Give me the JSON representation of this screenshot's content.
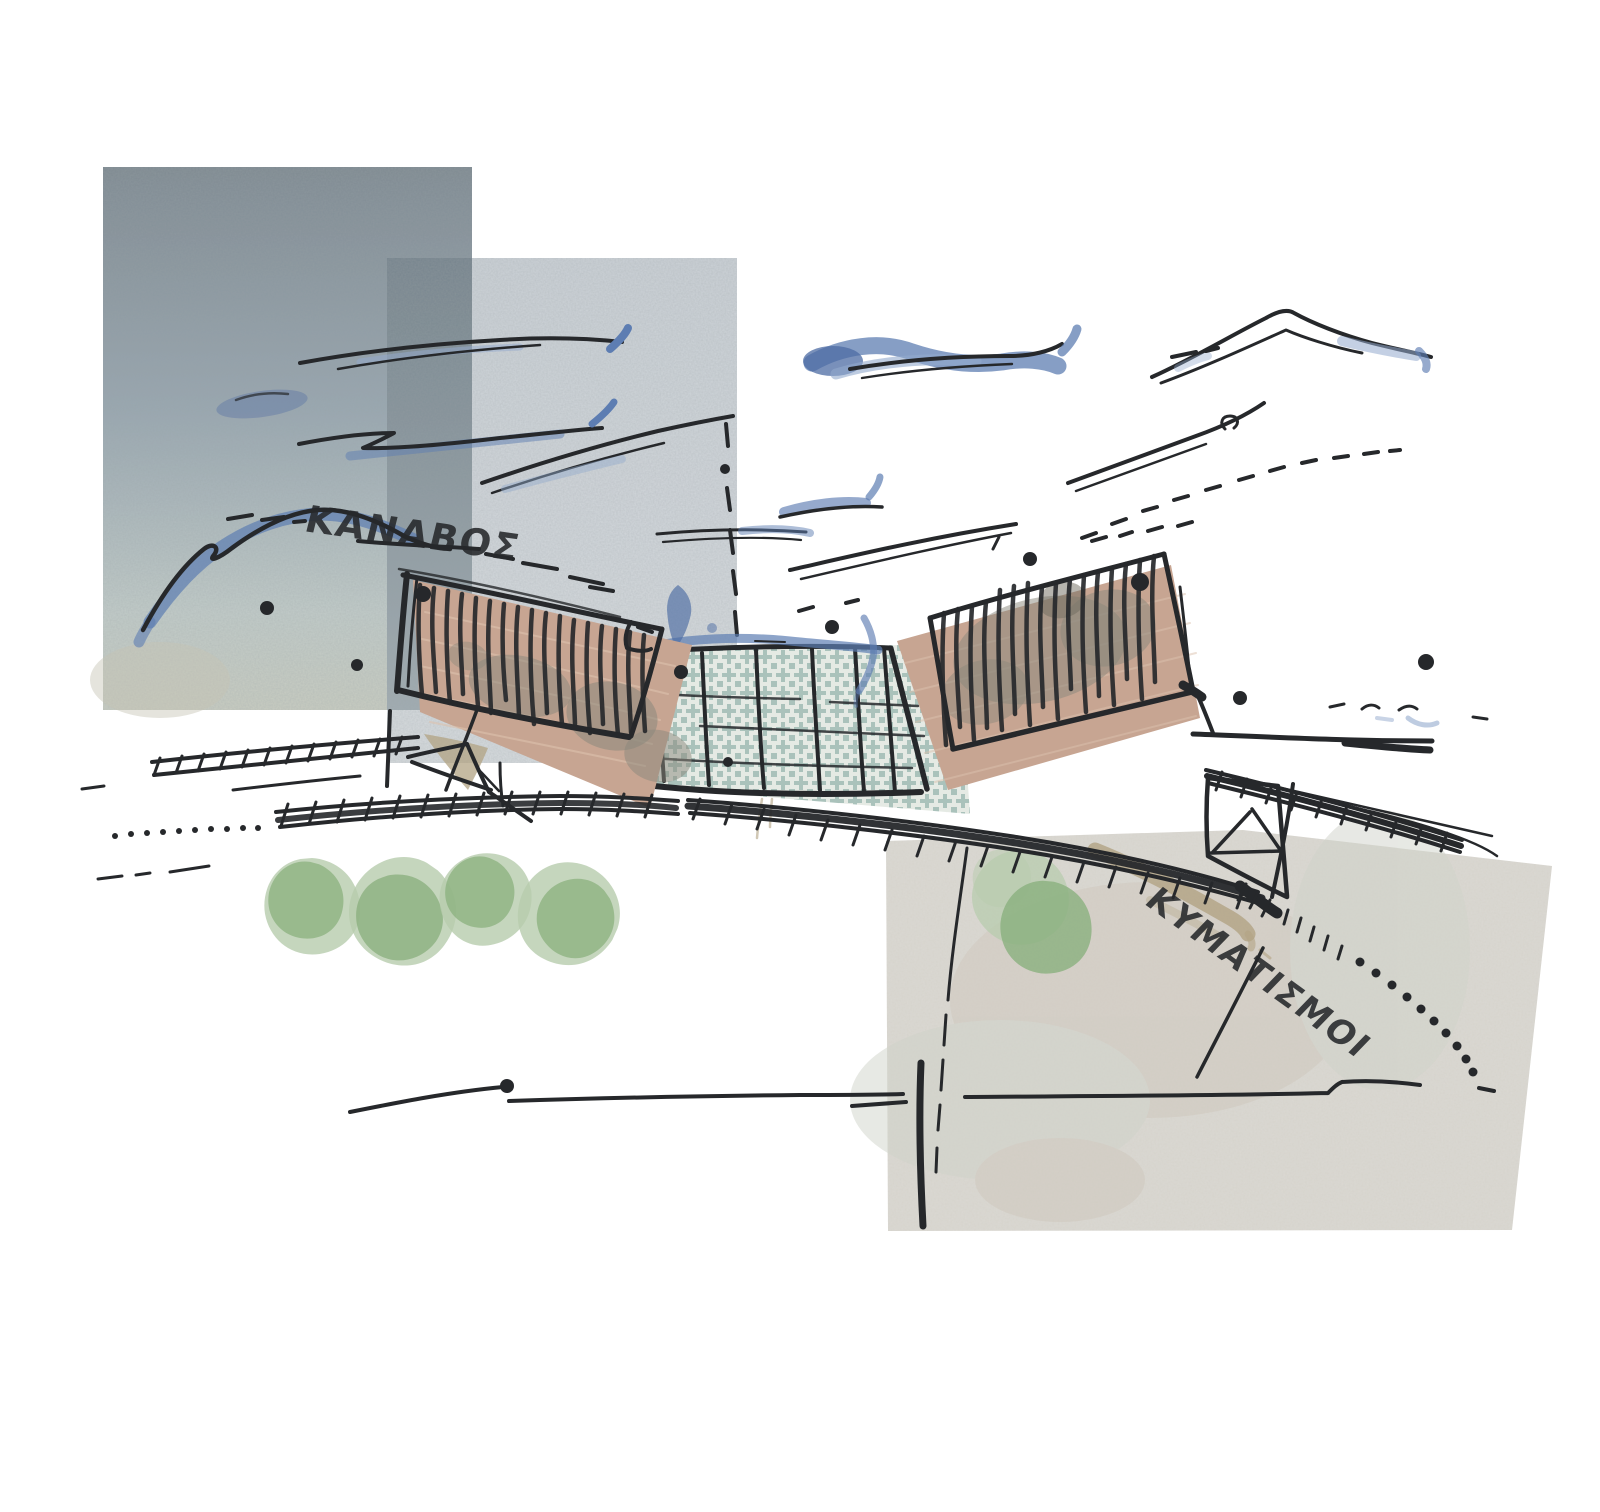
{
  "artwork": {
    "type": "architectural-concept-sketch-collage",
    "labels": {
      "kanavos": "ΚΑΝΑΒΟΣ",
      "kymatismoi": "ΚΥΜΑΤΙΣΜΟΙ"
    },
    "colors": {
      "background": "#ffffff",
      "ink": "#26282b",
      "watercolor_blue": "#5d7db2",
      "watercolor_blue_deep": "#4c6ba3",
      "watercolor_blue_light": "#93aacd",
      "panel_topleft_dark": "#7f8a92",
      "panel_topleft_mid": "#9aa8b1",
      "panel_topleft_light": "#c2ccc9",
      "panel_overlap_dark": "#76848d",
      "panel_overlap_light": "#a2adb2",
      "panel_center": "#ccd2d7",
      "panel_center_light": "#d7dbde",
      "panel_bottomright": "#dbd9d3",
      "panel_stain_warm": "#cfc8bd",
      "panel_stain_cool": "#d0d3ca",
      "building_tan": "#c7a592",
      "building_tan_line": "#dcc2ad",
      "building_blotch": "#8a887b",
      "building_blotch_dark": "#6f6c60",
      "checker_teal": "#6f9a91",
      "checker_bg": "#e5eae4",
      "tree_green_light": "#b7ccad",
      "tree_green_mid": "#8ab07e",
      "olive_tan": "#b2a383"
    }
  }
}
